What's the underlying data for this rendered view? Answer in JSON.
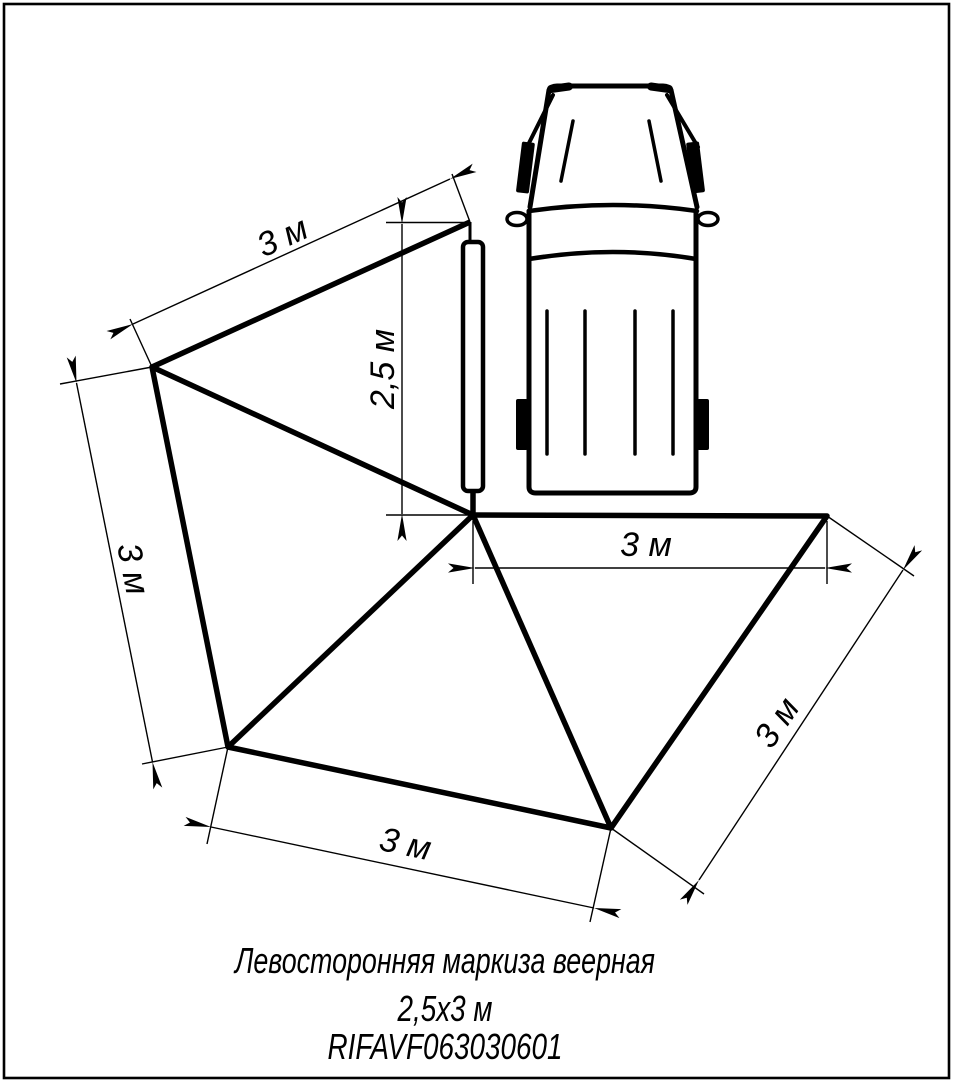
{
  "colors": {
    "ink": "#000000",
    "paper": "#ffffff"
  },
  "labels": {
    "dim_top": "3 м",
    "dim_mast": "2,5 м",
    "dim_left": "3 м",
    "dim_bottom": "3 м",
    "dim_rear": "3 м",
    "dim_right": "3 м"
  },
  "caption": {
    "line1": "Левосторонняя маркиза веерная",
    "line2": "2,5х3 м",
    "line3": "RIFAVF063030601"
  }
}
